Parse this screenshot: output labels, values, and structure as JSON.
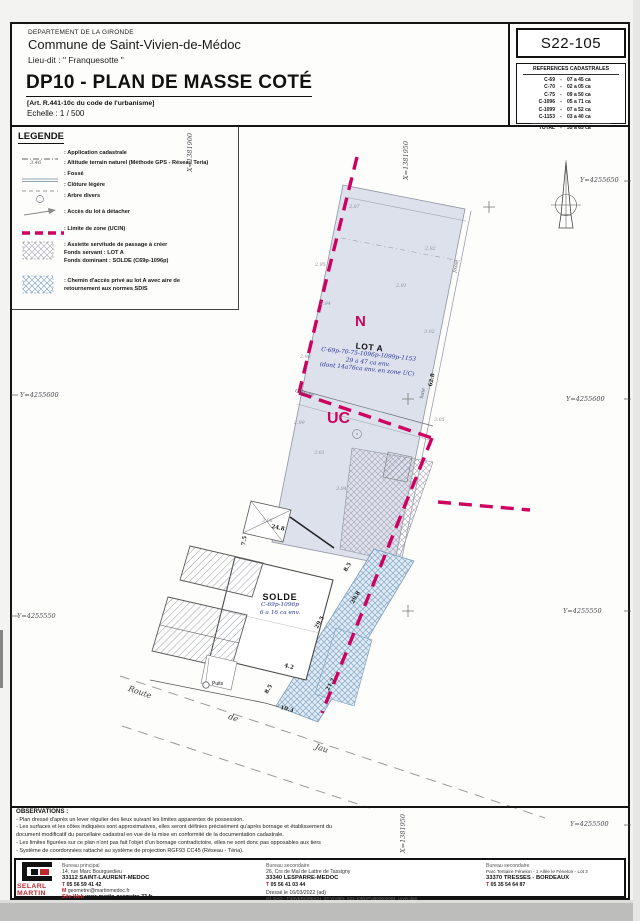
{
  "header": {
    "department": "DEPARTEMENT DE LA GIRONDE",
    "commune": "Commune de Saint-Vivien-de-Médoc",
    "lieu_dit": "Lieu-dit : \" Franquesotte \"",
    "title": "DP10 - PLAN DE MASSE COTÉ",
    "article": "[Art. R.441-10c du code de l'urbanisme]",
    "echelle": "Echelle : 1 / 500"
  },
  "references": {
    "code": "S22-105",
    "title": "REFERENCES CADASTRALES",
    "sep": "-",
    "rows": [
      {
        "ref": "C-69",
        "area": "07 a 45 ca"
      },
      {
        "ref": "C-70",
        "area": "02 a 05 ca"
      },
      {
        "ref": "C-75",
        "area": "09 a 50 ca"
      },
      {
        "ref": "C-1096",
        "area": "05 a 71 ca"
      },
      {
        "ref": "C-1099",
        "area": "07 a 52 ca"
      },
      {
        "ref": "C-1153",
        "area": "03 a 40 ca"
      }
    ],
    "total": {
      "ref": "TOTAL",
      "area": "35 a 63 ca"
    }
  },
  "legend": {
    "title": "LEGENDE",
    "altitude_symbol": "3.46",
    "items": [
      {
        "label": ": Application cadastrale"
      },
      {
        "label": ": Altitude terrain naturel (Méthode GPS - Réseau Teria)"
      },
      {
        "label": ": Fossé"
      },
      {
        "label": ": Clôture légère"
      },
      {
        "label": ": Arbre divers"
      },
      {
        "label": ": Accès du lot à détacher"
      },
      {
        "label": ": Limite de zone (UC/N)"
      },
      {
        "label": ": Assiette servitude de passage à créer",
        "line2": "Fonds servant : LOT A",
        "line3": "Fonds dominant : SOLDE (C69p-1096p)"
      },
      {
        "label": ": Chemin d'accès privé au lot A avec aire de",
        "line2": "retournement aux normes SDIS"
      }
    ]
  },
  "plan": {
    "zone_n": "N",
    "zone_uc": "UC",
    "lot_a": {
      "name": "LOT A",
      "refs": "C-69p-70-75-1096p-1099p-1153",
      "area": "29 a 47 ca env.",
      "note": "(dont 14a76ca env. en zone UC)"
    },
    "solde": {
      "name": "SOLDE",
      "refs": "C-69p-1096p",
      "area": "6 a 16 ca env."
    },
    "road": [
      "Route",
      "de",
      "Jau"
    ],
    "puits": "Puits",
    "cloture": "Clôture",
    "fosse": "fossé",
    "haie": "haie",
    "coords": {
      "y4255650": "Y=4255650",
      "y4255600": "Y=4255600",
      "y4255550": "Y=4255550",
      "y4255500": "Y=4255500",
      "x1381900": "X=1381900",
      "x1381950": "X=1381950"
    },
    "dims": [
      "24.8",
      "7.5",
      "8.5",
      "29.8",
      "29.5",
      "4.2",
      "8.5",
      "21.7",
      "10.3",
      "62.8"
    ],
    "altitudes": [
      "2.87",
      "2.92",
      "2.95",
      "2.91",
      "2.94",
      "3.02",
      "2.96",
      "3.05",
      "3.01",
      "3.04",
      "3.08",
      "2.99"
    ]
  },
  "observations": {
    "title": "OBSERVATIONS :",
    "lines": [
      "- Plan dressé d'après un lever régulier des lieux suivant les limites apparentes de possession.",
      "- Les surfaces et les côtes indiquées sont approximatives, elles seront définies précisément qu'après bornage et établissement du",
      "document modificatif du parcellaire cadastral en vue de la mise en conformité de la documentation cadastrale.",
      "- Les limites figurées sur ce plan n'ont pas fait l'objet d'un bornage contradictoire, elles ne sont donc pas opposables aux tiers",
      "- Système de coordonnées rattaché au système de projection RGF93 CC45 (Réseau - Téria)."
    ]
  },
  "footer": {
    "logo": {
      "line1": "SELARL",
      "line2": "MARTIN"
    },
    "principal": {
      "title": "Bureau principal",
      "address1": "14, rue Marc Bourguedieu",
      "address2": "33112 SAINT-LAURENT-MEDOC",
      "phone_label": "T",
      "phone": "05 56 59 41 42",
      "email_label": "M",
      "email": "geometre@martinmedoc.fr",
      "web_label": "Site Web",
      "web": "www.martin-geometre-33.fr"
    },
    "sec1": {
      "title": "Bureau secondaire",
      "address1": "26, Crs de Mal de Lattre de Tassigny",
      "address2": "33340 LESPARRE-MEDOC",
      "phone_label": "T",
      "phone": "05 56 41 03 44"
    },
    "sec2": {
      "title": "Bureau secondaire",
      "address1": "Parc Tertiaire Fénelon - 1 Allée le Fénelon - Lot 3",
      "address2": "33370 TRESSES - BORDEAUX",
      "phone_label": "T",
      "phone": "05 35 54 64 87"
    },
    "dressed": "Dressé le 16/03/2022 (ad)",
    "ref_dao": "réf. DAO : T:\\DIVERS\\REICH_ST-VIVIEN_S22-105\\DP\\4900000069_Lever.dwg"
  }
}
